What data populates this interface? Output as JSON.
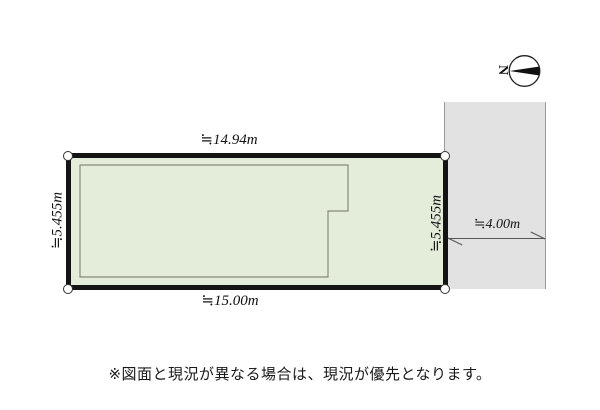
{
  "diagram": {
    "compass": {
      "north_label": "N"
    },
    "plot": {
      "top_dimension": "≒14.94m",
      "bottom_dimension": "≒15.00m",
      "left_dimension": "≒5.455m",
      "right_dimension": "≒5.455m"
    },
    "road": {
      "width_dimension": "≒4.00m"
    },
    "note": "※図面と現況が異なる場合は、現況が優先となります。"
  },
  "colors": {
    "plot_fill": "#e4ecda",
    "plot_border": "#141414",
    "road_fill": "#e2e2e2",
    "road_edge": "#9b9b9b",
    "building_outline": "#878c7a",
    "background": "#ffffff"
  }
}
